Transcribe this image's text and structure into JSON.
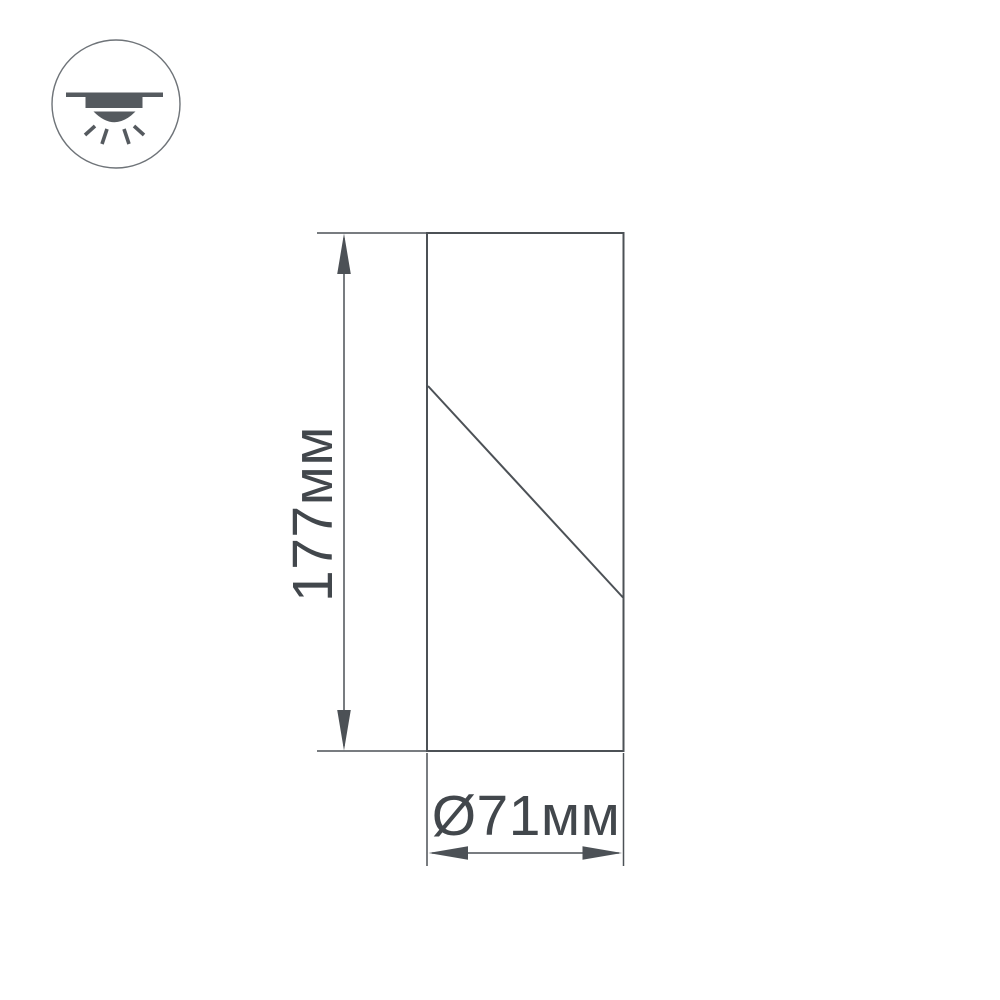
{
  "page": {
    "background_color": "#ffffff",
    "line_color": "#4c5156",
    "text_color": "#42474c",
    "icon_color": "#555a5f",
    "icon_circle_border_color": "#6e7378"
  },
  "icon": {
    "name": "surface-ceiling-downlight-icon",
    "description": "ceiling-mounted light fixture shining downward"
  },
  "drawing": {
    "type": "technical-dimension-drawing",
    "height_label": "177мм",
    "height_mm": 177,
    "diameter_label": "Ø71мм",
    "diameter_mm": 71
  }
}
